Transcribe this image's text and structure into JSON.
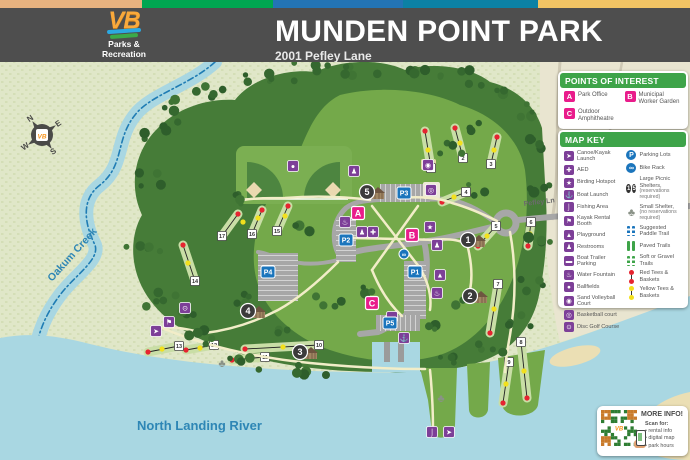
{
  "header": {
    "title": "MUNDEN POINT PARK",
    "subtitle": "2001 Pefley Lane",
    "logo": {
      "mark": "VB",
      "line1": "Parks &",
      "line2": "Recreation"
    }
  },
  "colors": {
    "strip": [
      "#E7B27F",
      "#00A651",
      "#2374B5",
      "#0C81A5",
      "#F2C464"
    ],
    "header_bg": "#4E4E4E",
    "legend_green": "#3EA449",
    "pink": "#E91C8B",
    "purple": "#7D3F98",
    "blue": "#1B75BC",
    "water": "#A9D7E2",
    "road": "#A7A7A7",
    "red_tee": "#E62430",
    "yellow_tee": "#F2E01D"
  },
  "map": {
    "labels": {
      "creek": "Oakum Creek",
      "river": "North Landing River",
      "road": "Pefley Ln"
    },
    "compass": {
      "n": "N",
      "e": "E",
      "s": "S",
      "w": "W",
      "logo": "VB"
    },
    "poi_markers": [
      {
        "label": "A",
        "x": 358,
        "y": 213
      },
      {
        "label": "B",
        "x": 412,
        "y": 235
      },
      {
        "label": "C",
        "x": 372,
        "y": 303
      }
    ],
    "parking_markers": [
      {
        "label": "P1",
        "x": 415,
        "y": 272
      },
      {
        "label": "P2",
        "x": 346,
        "y": 240
      },
      {
        "label": "P3",
        "x": 404,
        "y": 193
      },
      {
        "label": "P4",
        "x": 268,
        "y": 272
      },
      {
        "label": "P5",
        "x": 390,
        "y": 323
      }
    ],
    "shelter_markers": [
      {
        "label": "1",
        "x": 468,
        "y": 240
      },
      {
        "label": "2",
        "x": 470,
        "y": 296
      },
      {
        "label": "3",
        "x": 300,
        "y": 352
      },
      {
        "label": "4",
        "x": 248,
        "y": 311
      },
      {
        "label": "5",
        "x": 367,
        "y": 192
      }
    ],
    "holes": [
      {
        "n": "1",
        "rx": 425,
        "ry": 131,
        "yx": 428,
        "yy": 150,
        "nx": 431,
        "ny": 168
      },
      {
        "n": "2",
        "rx": 455,
        "ry": 128,
        "yx": 460,
        "yy": 143,
        "nx": 463,
        "ny": 158
      },
      {
        "n": "3",
        "rx": 497,
        "ry": 137,
        "yx": 494,
        "yy": 150,
        "nx": 491,
        "ny": 164
      },
      {
        "n": "4",
        "rx": 442,
        "ry": 202,
        "yx": 454,
        "yy": 197,
        "nx": 466,
        "ny": 192
      },
      {
        "n": "5",
        "rx": 478,
        "ry": 246,
        "yx": 487,
        "yy": 236,
        "nx": 496,
        "ny": 226
      },
      {
        "n": "6",
        "rx": 528,
        "ry": 246,
        "yx": 530,
        "yy": 234,
        "nx": 531,
        "ny": 222
      },
      {
        "n": "7",
        "rx": 490,
        "ry": 333,
        "yx": 494,
        "yy": 309,
        "nx": 498,
        "ny": 284
      },
      {
        "n": "8",
        "rx": 527,
        "ry": 398,
        "yx": 524,
        "yy": 371,
        "nx": 521,
        "ny": 342
      },
      {
        "n": "9",
        "rx": 503,
        "ry": 403,
        "yx": 506,
        "yy": 384,
        "nx": 509,
        "ny": 362
      },
      {
        "n": "10",
        "rx": 245,
        "ry": 349,
        "yx": 283,
        "yy": 347,
        "nx": 319,
        "ny": 345
      },
      {
        "n": "11",
        "rx": 232,
        "ry": 360,
        "yx": 249,
        "yy": 358,
        "nx": 265,
        "ny": 357
      },
      {
        "n": "12",
        "rx": 186,
        "ry": 350,
        "yx": 200,
        "yy": 348,
        "nx": 214,
        "ny": 345
      },
      {
        "n": "13",
        "rx": 148,
        "ry": 352,
        "yx": 162,
        "yy": 349,
        "nx": 179,
        "ny": 346
      },
      {
        "n": "14",
        "rx": 183,
        "ry": 245,
        "yx": 188,
        "yy": 263,
        "nx": 195,
        "ny": 281
      },
      {
        "n": "15",
        "rx": 288,
        "ry": 206,
        "yx": 285,
        "yy": 216,
        "nx": 277,
        "ny": 231
      },
      {
        "n": "16",
        "rx": 262,
        "ry": 210,
        "yx": 258,
        "yy": 218,
        "nx": 252,
        "ny": 234
      },
      {
        "n": "17",
        "rx": 238,
        "ry": 214,
        "yx": 243,
        "yy": 222,
        "nx": 222,
        "ny": 236
      }
    ],
    "amenity_icons": [
      {
        "icon": "restrooms",
        "x": 354,
        "y": 171
      },
      {
        "icon": "ballfields",
        "x": 293,
        "y": 166
      },
      {
        "icon": "sand-volleyball-court",
        "x": 428,
        "y": 165
      },
      {
        "icon": "basketball-court",
        "x": 431,
        "y": 190
      },
      {
        "icon": "water-fountain",
        "x": 345,
        "y": 222
      },
      {
        "icon": "restrooms",
        "x": 362,
        "y": 232
      },
      {
        "icon": "aed",
        "x": 373,
        "y": 232
      },
      {
        "icon": "birding-hotspot",
        "x": 430,
        "y": 227
      },
      {
        "icon": "restrooms",
        "x": 437,
        "y": 245
      },
      {
        "icon": "playground",
        "x": 440,
        "y": 275
      },
      {
        "icon": "water-fountain",
        "x": 437,
        "y": 293
      },
      {
        "icon": "boat-trailer-parking",
        "x": 392,
        "y": 317
      },
      {
        "icon": "boat-launch",
        "x": 404,
        "y": 338
      },
      {
        "icon": "disc-golf-course",
        "x": 185,
        "y": 308
      },
      {
        "icon": "kayak-rental-booth",
        "x": 169,
        "y": 322
      },
      {
        "icon": "canoe-kayak-launch",
        "x": 156,
        "y": 331
      },
      {
        "icon": "fishing-area",
        "x": 432,
        "y": 432
      },
      {
        "icon": "canoe-kayak-launch",
        "x": 449,
        "y": 432
      }
    ],
    "small_shelters": [
      {
        "x": 441,
        "y": 398
      },
      {
        "x": 222,
        "y": 363
      }
    ],
    "bike_racks": [
      {
        "x": 404,
        "y": 254
      }
    ]
  },
  "points_of_interest": {
    "title": "POINTS OF INTEREST",
    "items": [
      {
        "label": "A",
        "text": "Park Office"
      },
      {
        "label": "B",
        "text": "Municipal Worker Garden"
      },
      {
        "label": "C",
        "text": "Outdoor Amphitheatre"
      }
    ]
  },
  "map_key": {
    "title": "MAP KEY",
    "left": [
      {
        "icon": "canoe-kayak-launch",
        "text": "Canoe/Kayak Launch"
      },
      {
        "icon": "aed",
        "text": "AED"
      },
      {
        "icon": "birding-hotspot",
        "text": "Birding Hotspot"
      },
      {
        "icon": "boat-launch",
        "text": "Boat Launch"
      },
      {
        "icon": "fishing-area",
        "text": "Fishing Area"
      },
      {
        "icon": "kayak-rental-booth",
        "text": "Kayak Rental Booth"
      },
      {
        "icon": "playground",
        "text": "Playground"
      },
      {
        "icon": "restrooms",
        "text": "Restrooms"
      },
      {
        "icon": "boat-trailer-parking",
        "text": "Boat Trailer Parking"
      },
      {
        "icon": "water-fountain",
        "text": "Water Fountain"
      },
      {
        "icon": "ballfields",
        "text": "Ballfields"
      },
      {
        "icon": "sand-volleyball-court",
        "text": "Sand Volleyball Court"
      },
      {
        "icon": "basketball-court",
        "text": "Basketball court"
      },
      {
        "icon": "disc-golf-course",
        "text": "Disc Golf Course"
      }
    ],
    "right": [
      {
        "icon": "parking-lots",
        "text": "Parking Lots",
        "glyph": "P"
      },
      {
        "icon": "bike-rack",
        "text": "Bike Rack"
      },
      {
        "icon": "large-picnic-shelters",
        "text": "Large Picnic Shelters,",
        "note": "(reservations required)",
        "badges": [
          "1",
          "5"
        ]
      },
      {
        "icon": "small-shelter",
        "text": "Small Shelter,",
        "note": "(no reservations required)"
      },
      {
        "icon": "suggested-paddle-trail",
        "text": "Suggested Paddle Trail"
      },
      {
        "icon": "paved-trails",
        "text": "Paved Trails"
      },
      {
        "icon": "soft-gravel-trails",
        "text": "Soft or Gravel Trails"
      },
      {
        "icon": "red-tees",
        "text": "Red Tees & Baskets"
      },
      {
        "icon": "yellow-tees",
        "text": "Yellow Tees & Baskets"
      }
    ]
  },
  "more_info": {
    "title": "MORE INFO!",
    "scan_label": "Scan for:",
    "bullets": [
      "rental info",
      "digital map",
      "park hours"
    ]
  }
}
